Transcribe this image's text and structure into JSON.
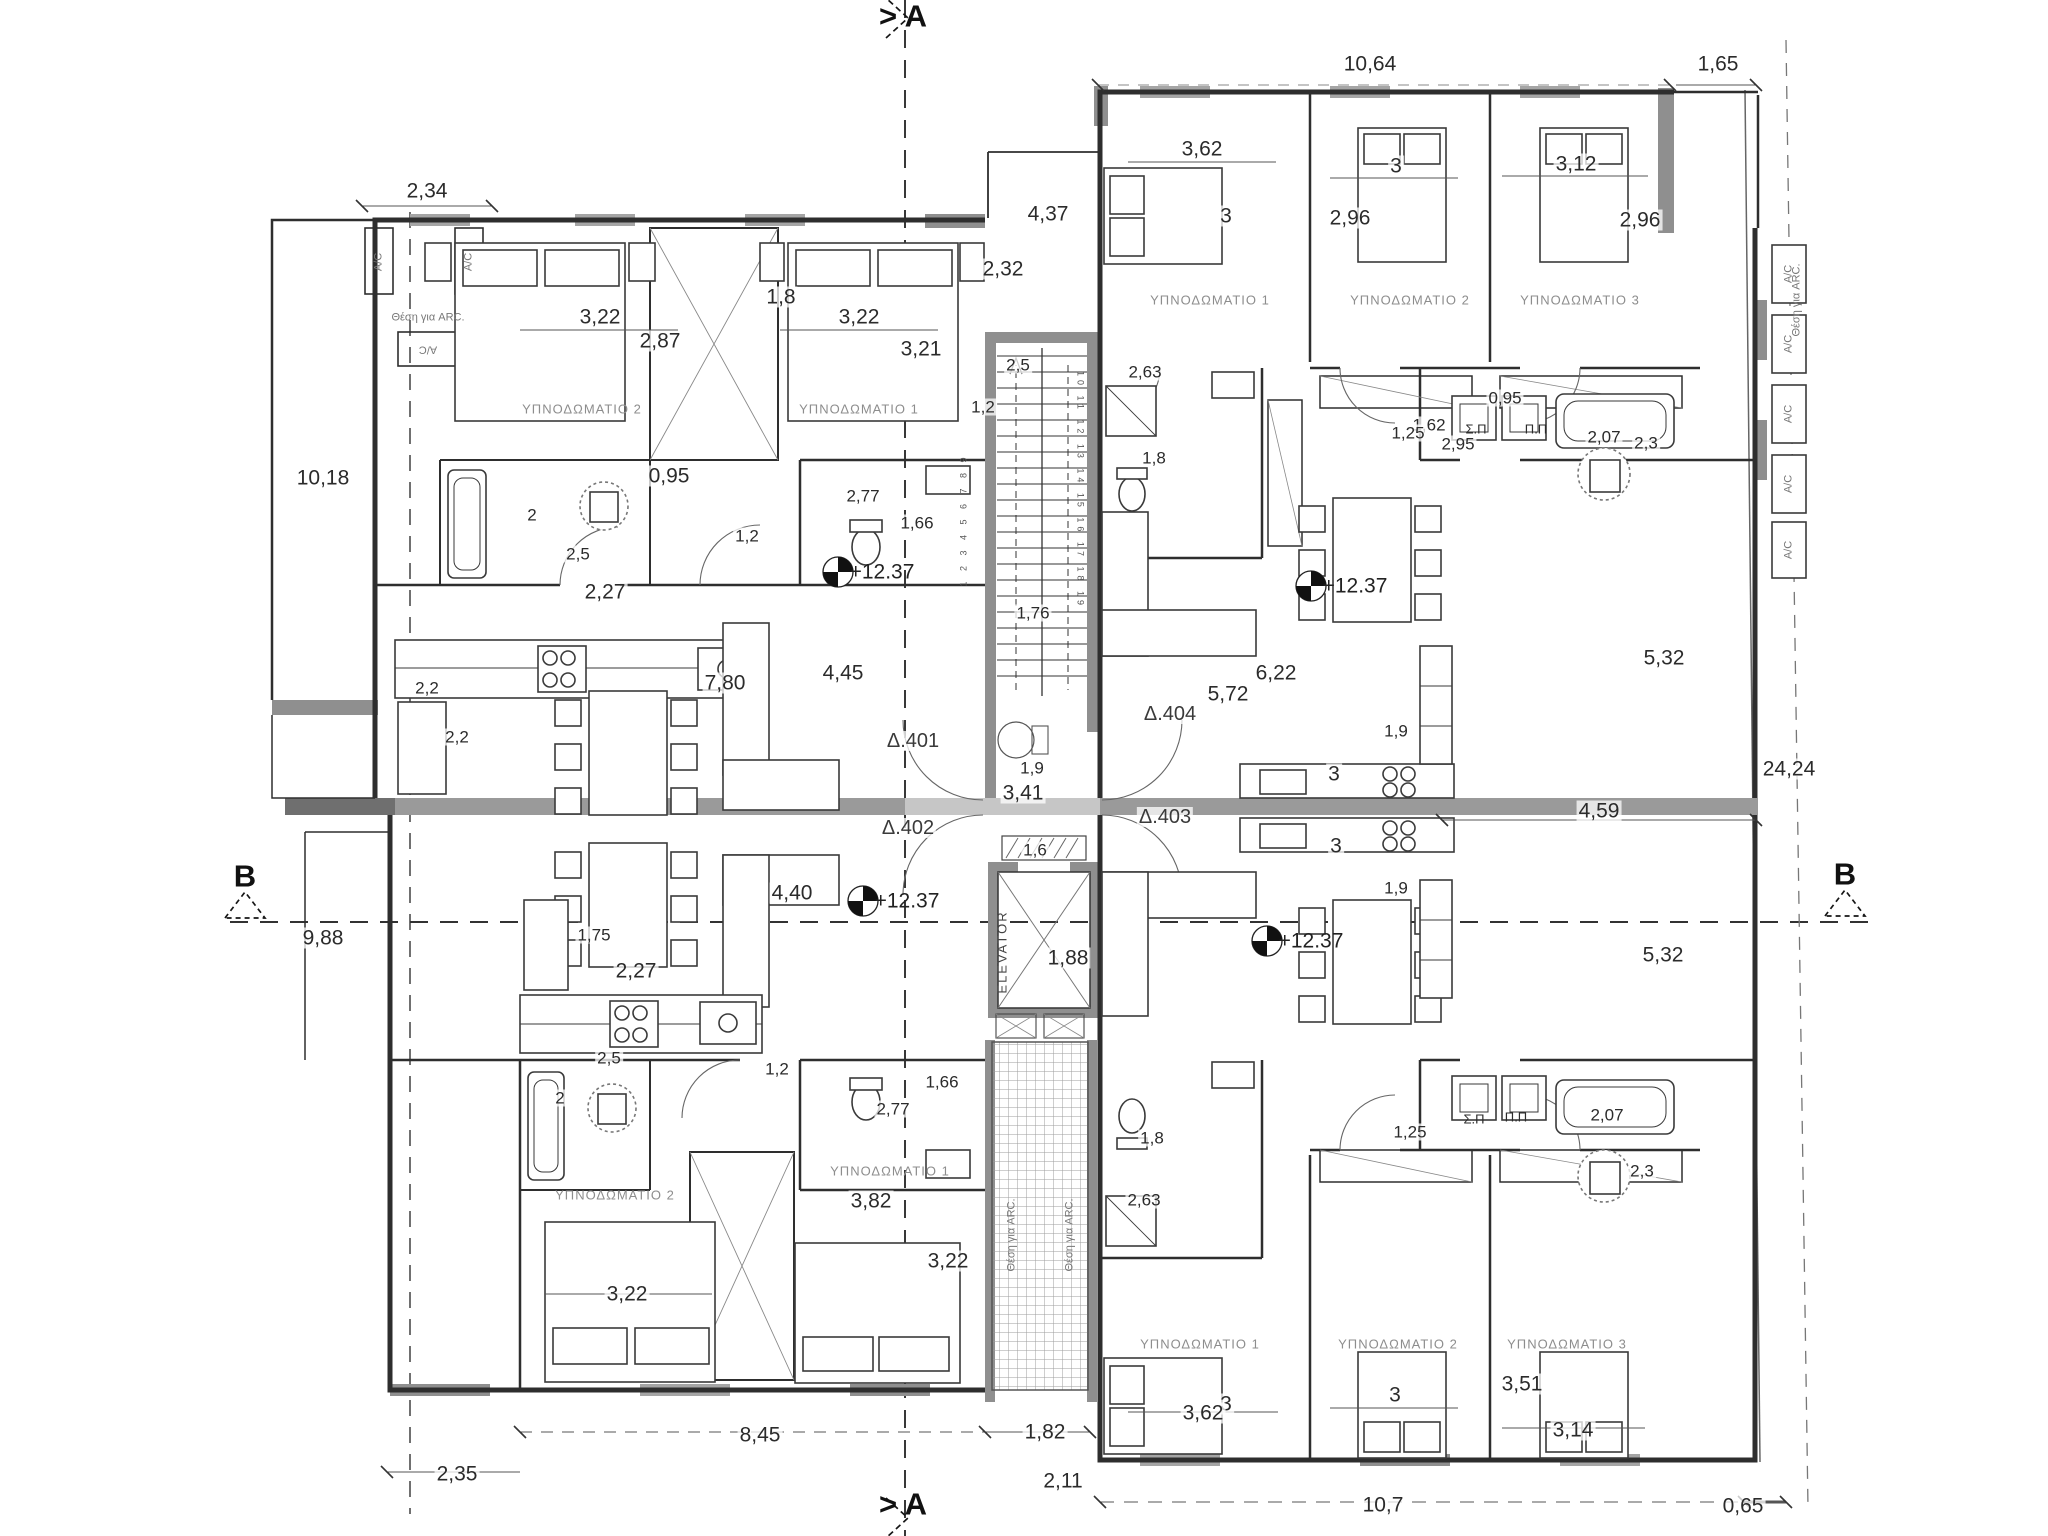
{
  "drawing": {
    "type": "apartment-floor-plan",
    "level": "+12.37",
    "apartments": [
      "Δ.401",
      "Δ.402",
      "Δ.403",
      "Δ.404"
    ],
    "section_a": "> A",
    "section_b": "B",
    "elevator": "ELEVATOR",
    "line_color": "#2e2e2e",
    "wall_gray": "#8f8f8f"
  },
  "labels": [
    {
      "t": "> A",
      "x": 903,
      "y": 16,
      "c": "sect"
    },
    {
      "t": "> A",
      "x": 903,
      "y": 1504,
      "c": "sect"
    },
    {
      "t": "B",
      "x": 245,
      "y": 876,
      "c": "sect"
    },
    {
      "t": "B",
      "x": 1845,
      "y": 874,
      "c": "sect"
    },
    {
      "t": "2,34",
      "x": 427,
      "y": 191,
      "c": "dim"
    },
    {
      "t": "10,18",
      "x": 323,
      "y": 478,
      "c": "dim"
    },
    {
      "t": "2,2",
      "x": 427,
      "y": 688,
      "c": "small"
    },
    {
      "t": "2,2",
      "x": 457,
      "y": 737,
      "c": "small"
    },
    {
      "t": "9,88",
      "x": 323,
      "y": 938,
      "c": "dim"
    },
    {
      "t": "2,35",
      "x": 457,
      "y": 1474,
      "c": "dim"
    },
    {
      "t": "3,22",
      "x": 600,
      "y": 317,
      "c": "dim"
    },
    {
      "t": "2,87",
      "x": 660,
      "y": 341,
      "c": "dim"
    },
    {
      "t": "1,8",
      "x": 781,
      "y": 297,
      "c": "dim"
    },
    {
      "t": "3,22",
      "x": 859,
      "y": 317,
      "c": "dim"
    },
    {
      "t": "3,21",
      "x": 921,
      "y": 349,
      "c": "dim"
    },
    {
      "t": "ΥΠΝΟΔΩΜΑΤΙΟ 2",
      "x": 582,
      "y": 409,
      "c": "room"
    },
    {
      "t": "ΥΠΝΟΔΩΜΑΤΙΟ 1",
      "x": 859,
      "y": 409,
      "c": "room"
    },
    {
      "t": "0,95",
      "x": 669,
      "y": 476,
      "c": "dim"
    },
    {
      "t": "2",
      "x": 532,
      "y": 515,
      "c": "small"
    },
    {
      "t": "2,5",
      "x": 578,
      "y": 554,
      "c": "small"
    },
    {
      "t": "1,2",
      "x": 747,
      "y": 536,
      "c": "small"
    },
    {
      "t": "2,77",
      "x": 863,
      "y": 496,
      "c": "small"
    },
    {
      "t": "1,66",
      "x": 917,
      "y": 523,
      "c": "small"
    },
    {
      "t": "2,27",
      "x": 605,
      "y": 592,
      "c": "dim"
    },
    {
      "t": "7,80",
      "x": 725,
      "y": 683,
      "c": "dim"
    },
    {
      "t": "4,45",
      "x": 843,
      "y": 673,
      "c": "dim"
    },
    {
      "t": "+12.37",
      "x": 882,
      "y": 572,
      "c": "level"
    },
    {
      "t": "Δ.401",
      "x": 913,
      "y": 741,
      "c": "apt"
    },
    {
      "t": "4,37",
      "x": 1048,
      "y": 214,
      "c": "dim"
    },
    {
      "t": "2,32",
      "x": 1003,
      "y": 269,
      "c": "dim"
    },
    {
      "t": "2,5",
      "x": 1018,
      "y": 365,
      "c": "small"
    },
    {
      "t": "1,2",
      "x": 983,
      "y": 407,
      "c": "small"
    },
    {
      "t": "1,76",
      "x": 1033,
      "y": 613,
      "c": "small"
    },
    {
      "t": "1,9",
      "x": 1032,
      "y": 768,
      "c": "small"
    },
    {
      "t": "3,41",
      "x": 1023,
      "y": 793,
      "c": "dim"
    },
    {
      "t": "Δ.402",
      "x": 908,
      "y": 828,
      "c": "apt"
    },
    {
      "t": "Δ.404",
      "x": 1170,
      "y": 714,
      "c": "apt"
    },
    {
      "t": "Δ.403",
      "x": 1165,
      "y": 817,
      "c": "apt"
    },
    {
      "t": "1,6",
      "x": 1035,
      "y": 850,
      "c": "small"
    },
    {
      "t": "ELEVATOR",
      "x": 1002,
      "y": 952,
      "c": "elev",
      "r": -90
    },
    {
      "t": "1,88",
      "x": 1068,
      "y": 958,
      "c": "dim"
    },
    {
      "t": "1 2 3 4 5 6 7 8 9",
      "x": 964,
      "y": 520,
      "c": "stair",
      "r": -90
    },
    {
      "t": "10 11 12 13 14 15 16 17 18 19",
      "x": 1080,
      "y": 490,
      "c": "stair",
      "r": 90
    },
    {
      "t": "10,64",
      "x": 1370,
      "y": 64,
      "c": "dim"
    },
    {
      "t": "1,65",
      "x": 1718,
      "y": 64,
      "c": "dim"
    },
    {
      "t": "3,62",
      "x": 1202,
      "y": 149,
      "c": "dim"
    },
    {
      "t": "3",
      "x": 1396,
      "y": 166,
      "c": "dim"
    },
    {
      "t": "3,12",
      "x": 1576,
      "y": 164,
      "c": "dim"
    },
    {
      "t": "3",
      "x": 1226,
      "y": 216,
      "c": "dim"
    },
    {
      "t": "2,96",
      "x": 1350,
      "y": 218,
      "c": "dim"
    },
    {
      "t": "2,96",
      "x": 1640,
      "y": 220,
      "c": "dim"
    },
    {
      "t": "ΥΠΝΟΔΩΜΑΤΙΟ 1",
      "x": 1210,
      "y": 300,
      "c": "room"
    },
    {
      "t": "ΥΠΝΟΔΩΜΑΤΙΟ 2",
      "x": 1410,
      "y": 300,
      "c": "room"
    },
    {
      "t": "ΥΠΝΟΔΩΜΑΤΙΟ 3",
      "x": 1580,
      "y": 300,
      "c": "room"
    },
    {
      "t": "2,63",
      "x": 1145,
      "y": 372,
      "c": "small"
    },
    {
      "t": "1,8",
      "x": 1154,
      "y": 458,
      "c": "small"
    },
    {
      "t": "0,95",
      "x": 1505,
      "y": 398,
      "c": "small"
    },
    {
      "t": "1,62",
      "x": 1429,
      "y": 425,
      "c": "small"
    },
    {
      "t": "2,95",
      "x": 1458,
      "y": 444,
      "c": "small"
    },
    {
      "t": "2,3",
      "x": 1646,
      "y": 443,
      "c": "small"
    },
    {
      "t": "1,25",
      "x": 1408,
      "y": 433,
      "c": "small"
    },
    {
      "t": "Σ.Π",
      "x": 1476,
      "y": 429,
      "c": "tiny"
    },
    {
      "t": "Π.Π",
      "x": 1536,
      "y": 429,
      "c": "tiny"
    },
    {
      "t": "2,07",
      "x": 1604,
      "y": 437,
      "c": "small"
    },
    {
      "t": "+12.37",
      "x": 1355,
      "y": 586,
      "c": "level"
    },
    {
      "t": "6,22",
      "x": 1276,
      "y": 673,
      "c": "dim"
    },
    {
      "t": "5,72",
      "x": 1228,
      "y": 694,
      "c": "dim"
    },
    {
      "t": "1,9",
      "x": 1396,
      "y": 731,
      "c": "small"
    },
    {
      "t": "3",
      "x": 1334,
      "y": 774,
      "c": "dim"
    },
    {
      "t": "5,32",
      "x": 1664,
      "y": 658,
      "c": "dim"
    },
    {
      "t": "4,59",
      "x": 1599,
      "y": 811,
      "c": "dim"
    },
    {
      "t": "24,24",
      "x": 1789,
      "y": 769,
      "c": "dim"
    },
    {
      "t": "5,32",
      "x": 1663,
      "y": 955,
      "c": "dim"
    },
    {
      "t": "4,40",
      "x": 792,
      "y": 893,
      "c": "dim"
    },
    {
      "t": "+12.37",
      "x": 907,
      "y": 901,
      "c": "level"
    },
    {
      "t": "1,75",
      "x": 594,
      "y": 935,
      "c": "small"
    },
    {
      "t": "2,27",
      "x": 636,
      "y": 971,
      "c": "dim"
    },
    {
      "t": "2,5",
      "x": 609,
      "y": 1058,
      "c": "small"
    },
    {
      "t": "2",
      "x": 560,
      "y": 1098,
      "c": "small"
    },
    {
      "t": "1,2",
      "x": 777,
      "y": 1069,
      "c": "small"
    },
    {
      "t": "1,66",
      "x": 942,
      "y": 1082,
      "c": "small"
    },
    {
      "t": "2,77",
      "x": 893,
      "y": 1109,
      "c": "small"
    },
    {
      "t": "ΥΠΝΟΔΩΜΑΤΙΟ 2",
      "x": 615,
      "y": 1195,
      "c": "room"
    },
    {
      "t": "ΥΠΝΟΔΩΜΑΤΙΟ 1",
      "x": 890,
      "y": 1171,
      "c": "room"
    },
    {
      "t": "3,82",
      "x": 871,
      "y": 1201,
      "c": "dim"
    },
    {
      "t": "3,22",
      "x": 948,
      "y": 1261,
      "c": "dim"
    },
    {
      "t": "3,22",
      "x": 627,
      "y": 1294,
      "c": "dim"
    },
    {
      "t": "8,45",
      "x": 760,
      "y": 1435,
      "c": "dim"
    },
    {
      "t": "1,82",
      "x": 1045,
      "y": 1432,
      "c": "dim"
    },
    {
      "t": "2,11",
      "x": 1063,
      "y": 1481,
      "c": "dim"
    },
    {
      "t": "+12.37",
      "x": 1311,
      "y": 941,
      "c": "level"
    },
    {
      "t": "3",
      "x": 1336,
      "y": 846,
      "c": "dim"
    },
    {
      "t": "1,9",
      "x": 1396,
      "y": 888,
      "c": "small"
    },
    {
      "t": "1,8",
      "x": 1152,
      "y": 1138,
      "c": "small"
    },
    {
      "t": "2,63",
      "x": 1144,
      "y": 1200,
      "c": "small"
    },
    {
      "t": "1,25",
      "x": 1410,
      "y": 1132,
      "c": "small"
    },
    {
      "t": "Σ.Π",
      "x": 1474,
      "y": 1119,
      "c": "tiny"
    },
    {
      "t": "Π.Π",
      "x": 1516,
      "y": 1117,
      "c": "tiny"
    },
    {
      "t": "2,07",
      "x": 1607,
      "y": 1115,
      "c": "small"
    },
    {
      "t": "2,3",
      "x": 1642,
      "y": 1171,
      "c": "small"
    },
    {
      "t": "ΥΠΝΟΔΩΜΑΤΙΟ 1",
      "x": 1200,
      "y": 1344,
      "c": "room"
    },
    {
      "t": "ΥΠΝΟΔΩΜΑΤΙΟ 2",
      "x": 1398,
      "y": 1344,
      "c": "room"
    },
    {
      "t": "ΥΠΝΟΔΩΜΑΤΙΟ 3",
      "x": 1567,
      "y": 1344,
      "c": "room"
    },
    {
      "t": "3,51",
      "x": 1522,
      "y": 1384,
      "c": "dim"
    },
    {
      "t": "3",
      "x": 1226,
      "y": 1404,
      "c": "dim"
    },
    {
      "t": "3,62",
      "x": 1203,
      "y": 1413,
      "c": "dim"
    },
    {
      "t": "3",
      "x": 1395,
      "y": 1395,
      "c": "dim"
    },
    {
      "t": "3,14",
      "x": 1573,
      "y": 1430,
      "c": "dim"
    },
    {
      "t": "10,7",
      "x": 1383,
      "y": 1505,
      "c": "dim"
    },
    {
      "t": "0,65",
      "x": 1743,
      "y": 1506,
      "c": "dim"
    },
    {
      "t": "Θέση για ARC.",
      "x": 428,
      "y": 318,
      "c": "arc"
    },
    {
      "t": "A/C",
      "x": 379,
      "y": 262,
      "c": "arc",
      "r": -90
    },
    {
      "t": "A/C",
      "x": 469,
      "y": 262,
      "c": "arc",
      "r": -90
    },
    {
      "t": "A/C",
      "x": 428,
      "y": 349,
      "c": "arc",
      "r": 180
    },
    {
      "t": "Θέση για ARC.",
      "x": 1797,
      "y": 300,
      "c": "arc",
      "r": -90
    },
    {
      "t": "A/C",
      "x": 1789,
      "y": 274,
      "c": "arc",
      "r": -90
    },
    {
      "t": "A/C",
      "x": 1789,
      "y": 344,
      "c": "arc",
      "r": -90
    },
    {
      "t": "A/C",
      "x": 1789,
      "y": 414,
      "c": "arc",
      "r": -90
    },
    {
      "t": "A/C",
      "x": 1789,
      "y": 484,
      "c": "arc",
      "r": -90
    },
    {
      "t": "A/C",
      "x": 1789,
      "y": 550,
      "c": "arc",
      "r": -90
    },
    {
      "t": "Θέση για ARC.",
      "x": 1012,
      "y": 1235,
      "c": "arc",
      "r": -90
    },
    {
      "t": "Θέση για ARC.",
      "x": 1070,
      "y": 1235,
      "c": "arc",
      "r": -90
    }
  ]
}
